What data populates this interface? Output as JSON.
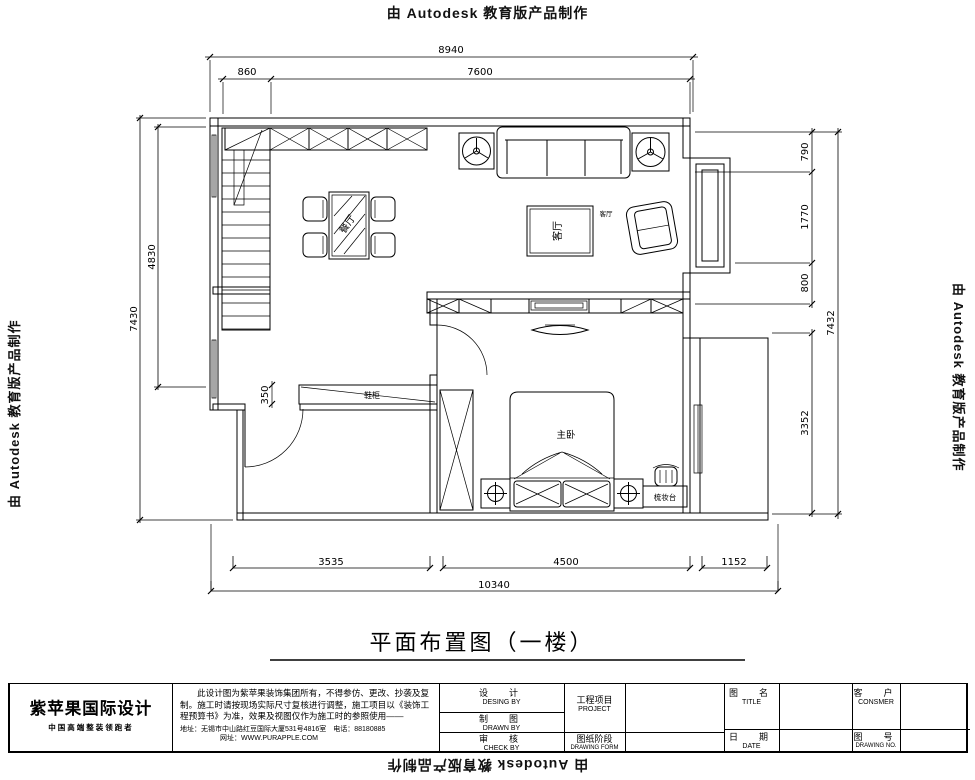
{
  "watermark": {
    "text": "由 Autodesk 教育版产品制作"
  },
  "plan": {
    "title": "平面布置图（一楼）",
    "rooms": {
      "dining": "餐厅",
      "living": "客厅",
      "living_small": "客厅",
      "master": "主卧",
      "shoe_cabinet": "鞋柜",
      "dresser": "梳妆台"
    },
    "dims": {
      "top_overall": "8940",
      "top_left": "860",
      "top_right": "7600",
      "left_outer": "7430",
      "left_inner": "4830",
      "shoe_depth": "350",
      "right_1": "790",
      "right_2": "1770",
      "right_3": "800",
      "right_4": "3352",
      "right_outer": "7432",
      "bottom_1": "3535",
      "bottom_2": "4500",
      "bottom_3": "1152",
      "bottom_overall": "10340"
    }
  },
  "titleblock": {
    "company": "紫苹果国际设计",
    "slogan": "中国高端整装领跑者",
    "disclaimer_1": "此设计图为紫苹果装饰集团所有，不得参仿、更改、抄袭及复",
    "disclaimer_2": "制。施工时请按现场实际尺寸复核进行调整，施工项目以《装饰工",
    "disclaimer_3": "程预算书》为准，效果及视图仅作为施工时的参照使用——",
    "address": "地址：无锡市中山路红豆国际大厦531号4816室　电话：88180885",
    "website": "网址：WWW.PURAPPLE.COM",
    "fields": {
      "design_cn": "设　计",
      "design_en": "DESING BY",
      "draw_cn": "制　图",
      "draw_en": "DRAWN BY",
      "check_cn": "审　核",
      "check_en": "CHECK BY",
      "project_cn": "工程项目",
      "project_en": "PROJECT",
      "stage_cn": "图纸阶段",
      "stage_en": "DRAWING FORM",
      "title_cn": "图　名",
      "title_en": "TITLE",
      "date_cn": "日　期",
      "date_en": "DATE",
      "customer_cn": "客　户",
      "customer_en": "CONSMER",
      "no_cn": "图　号",
      "no_en": "DRAWING NO."
    }
  }
}
